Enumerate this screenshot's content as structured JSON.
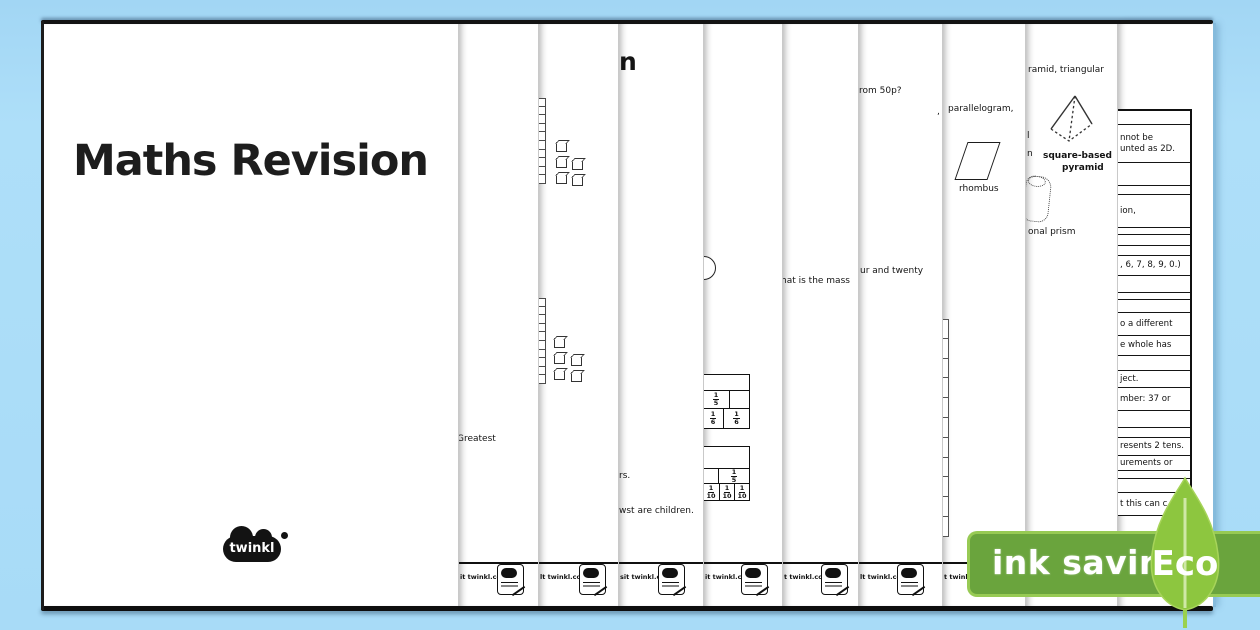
{
  "cover": {
    "title": "Maths Revision",
    "logo_text": "twinkl"
  },
  "strips": {
    "s2": {
      "fragment_greatest": "Greatest",
      "footer": "it twinkl.com"
    },
    "s3": {
      "footer": "lt twinkl.com"
    },
    "s4": {
      "title_fragment": "n",
      "fragment_rs": "rs.",
      "fragment_children": "wst are children.",
      "footer": "sit twinkl.com"
    },
    "s5": {
      "footer": "it twinkl.com",
      "fraction_table_1": {
        "row2": [
          "1/5",
          ""
        ],
        "row3": [
          "1/6",
          "1/6"
        ]
      },
      "fraction_table_2": {
        "row2": [
          "",
          "1/5"
        ],
        "row3": [
          "1/10",
          "1/10",
          "1/10"
        ]
      }
    },
    "s6": {
      "fragment_mass": "hat is the mass",
      "footer": "t twinkl.com"
    },
    "s7": {
      "fragment_50p": "rom 50p?",
      "fragment_twenty": "ur and twenty",
      "fragment_comma": ",",
      "footer": "lt twinkl.com"
    },
    "s8": {
      "fragment_parallelogram": "parallelogram,",
      "label_rhombus": "rhombus",
      "footer": "t twink"
    },
    "s9": {
      "fragment_triangular": "ramid, triangular",
      "fragment_l": "l",
      "fragment_n": "n",
      "label_square_based": "square-based",
      "label_pyramid": "pyramid",
      "fragment_prism": "onal prism"
    },
    "s10": {
      "rows": [
        {
          "h": 14,
          "t": ""
        },
        {
          "h": 38,
          "t": "nnot be|unted as 2D."
        },
        {
          "h": 23,
          "t": ""
        },
        {
          "h": 9,
          "t": ""
        },
        {
          "h": 33,
          "t": "ion,"
        },
        {
          "h": 7,
          "t": ""
        },
        {
          "h": 11,
          "t": ""
        },
        {
          "h": 10,
          "t": ""
        },
        {
          "h": 20,
          "t": ", 6, 7, 8, 9, 0.)"
        },
        {
          "h": 17,
          "t": ""
        },
        {
          "h": 7,
          "t": ""
        },
        {
          "h": 13,
          "t": ""
        },
        {
          "h": 23,
          "t": "o a different"
        },
        {
          "h": 20,
          "t": "e whole has"
        },
        {
          "h": 15,
          "t": ""
        },
        {
          "h": 17,
          "t": "ject."
        },
        {
          "h": 23,
          "t": "mber: 37 or"
        },
        {
          "h": 17,
          "t": ""
        },
        {
          "h": 10,
          "t": ""
        },
        {
          "h": 18,
          "t": "resents 2 tens."
        },
        {
          "h": 15,
          "t": "urements or"
        },
        {
          "h": 8,
          "t": ""
        },
        {
          "h": 14,
          "t": ""
        },
        {
          "h": 23,
          "t": "t this can c"
        }
      ]
    }
  },
  "eco_badge": {
    "ink_saving_label": "ink saving",
    "eco_label": "Eco",
    "banner_color": "#6aa43d",
    "banner_border_color": "#97ca54",
    "leaf_color": "#8dc63f",
    "leaf_rib_color": "#cfe8a6"
  }
}
